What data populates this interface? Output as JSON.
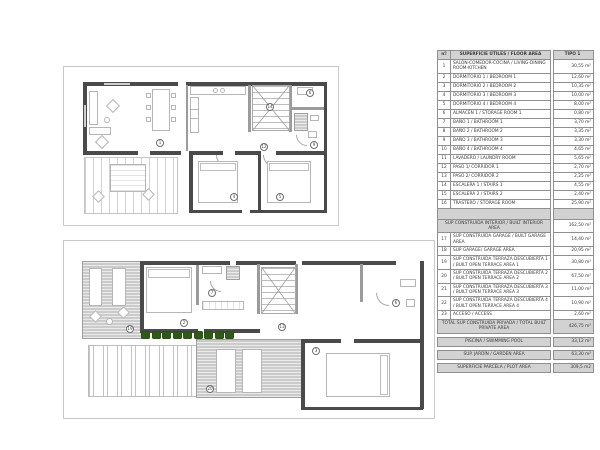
{
  "colors": {
    "wall": "#4a4a4a",
    "furniture_line": "#b6b6b6",
    "terrace_fill": "#cbcbcb",
    "hedge_green": "#2e5a18",
    "table_band_gray": "#d2d2d2",
    "table_border": "#8f8f8f"
  },
  "areas_table": {
    "header": {
      "num": "nº",
      "label": "SUPERFICIE ÚTILES / FLOOR AREA",
      "type": "TIPO 1"
    },
    "rows": [
      {
        "num": "1",
        "label": "SALÓN-COMEDOR-COCINA / LIVING-DINING ROOM-KITCHEN",
        "value": "30,55 m²"
      },
      {
        "num": "2",
        "label": "DORMITORIO 1 / BEDROOM 1",
        "value": "12,60 m²"
      },
      {
        "num": "3",
        "label": "DORMITORIO 2 / BEDROOM 2",
        "value": "10,35 m²"
      },
      {
        "num": "4",
        "label": "DORMITORIO 3 / BEDROOM 3",
        "value": "10,00 m²"
      },
      {
        "num": "5",
        "label": "DORMITORIO 4 / BEDROOM 4",
        "value": "8,00 m²"
      },
      {
        "num": "6",
        "label": "ALMACÉN 1 / STORAGE ROOM 1",
        "value": "0,80 m²"
      },
      {
        "num": "7",
        "label": "BAÑO 1 / BATHROOM 1",
        "value": "3,70 m²"
      },
      {
        "num": "8",
        "label": "BAÑO 2 / BATHROOM 2",
        "value": "3,35 m²"
      },
      {
        "num": "9",
        "label": "BAÑO 3 / BATHROOM 3",
        "value": "3,30 m²"
      },
      {
        "num": "10",
        "label": "BAÑO 4 / BATHROOM 4",
        "value": "4,65 m²"
      },
      {
        "num": "11",
        "label": "LAVADERO / LAUNDRY ROOM",
        "value": "5,65 m²"
      },
      {
        "num": "12",
        "label": "PASO 1/ CORRIDOR 1",
        "value": "2,70 m²"
      },
      {
        "num": "13",
        "label": "PASO 2/ CORRIDOR 2",
        "value": "2,25 m²"
      },
      {
        "num": "14",
        "label": "ESCALERA 1 / STAIRS 1",
        "value": "4,55 m²"
      },
      {
        "num": "15",
        "label": "ESCALERA 2 / STAIRS 2",
        "value": "2,40 m²"
      },
      {
        "num": "16",
        "label": "TRASTERO / STORAGE ROOM",
        "value": "25,90 m²"
      }
    ],
    "interior_total": {
      "label": "SUP CONSTRUIDA INTERIOR / BUILT INTERIOR AREA",
      "value": "162,50 m²"
    },
    "built_rows": [
      {
        "num": "17",
        "label": "SUP CONSTRUIDA GARAGE / BUILT GARAGE AREA",
        "value": "14,40 m²"
      },
      {
        "num": "18",
        "label": "SUP GARAGE/ GARAGE AREA",
        "value": "20,95 m²"
      },
      {
        "num": "19",
        "label": "SUP CONSTRUIDA TERRAZA DESCUBIERTA 1 / BUILT OPEN TERRACE AREA 1",
        "value": "30,80 m²"
      },
      {
        "num": "20",
        "label": "SUP CONSTRUIDA TERRAZA DESCUBIERTA 2 / BUILT OPEN TERRACE AREA 2",
        "value": "67,50 m²"
      },
      {
        "num": "21",
        "label": "SUP CONSTRUIDA TERRAZA DESCUBIERTA 3 / BUILT OPEN TERRACE AREA 3",
        "value": "11,00 m²"
      },
      {
        "num": "22",
        "label": "SUP CONSTRUIDA TERRAZA DESCUBIERTA 4 / BUILT OPEN TERRACE AREA 4",
        "value": "10,90 m²"
      },
      {
        "num": "23",
        "label": "ACCESO / ACCESS",
        "value": "2,60 m²"
      }
    ],
    "private_total": {
      "label": "TOTAL SUP CONSTRUIDA PRIVADA / TOTAL BUILT PRIVATE AREA",
      "value": "426,75 m²"
    },
    "pool": {
      "label": "PISCINA / SWIMMING POOL",
      "value": "33,12 m²"
    },
    "garden": {
      "label": "SUP. JARDÍN / GARDEN AREA",
      "value": "63,30 m²"
    },
    "plot": {
      "label": "SUPERFICIE PARCELA / PLOT AREA",
      "value": "309,5 m2"
    }
  },
  "plans": {
    "upper": {
      "markers": [
        "1",
        "14",
        "6",
        "9",
        "12",
        "4",
        "5"
      ]
    },
    "ground": {
      "markers": [
        "19",
        "2",
        "7",
        "13",
        "6",
        "3",
        "20"
      ]
    }
  }
}
